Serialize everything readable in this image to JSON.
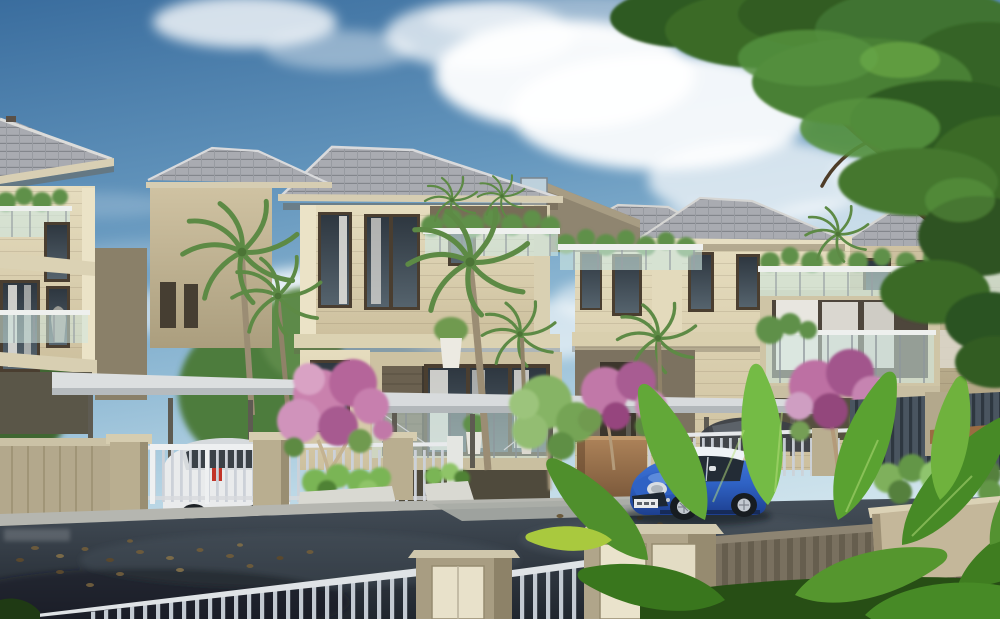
{
  "scene": {
    "type": "architectural-exterior-3d-render",
    "description": "Real-estate 3D rendering: a row of modern beige villas with grey hip tile roofs, glass-railed balconies and roof terraces with plants, palm trees and pink bougainvillea in front yards, silver picket fences with stone pillars, a white car parked behind a gate, a dark sedan behind a fence, a blue MINI-style hatchback with a white roof parked on a dark asphalt street with scattered fallen leaves, a slatted foreground fence with stone pillars, large glossy tropical leaves in the right foreground, and a leafy tree branch overhanging from the top-right under a blue sky with cumulus clouds.",
    "watermark_text": ""
  },
  "objects": [
    "sky",
    "cumulus-clouds",
    "overhanging-tree",
    "villa-left",
    "villa-main",
    "villa-back",
    "villa-right",
    "secondary-roof",
    "glass-balustrade-terrace",
    "balcony-box",
    "carport-canopy",
    "palm-trees",
    "bougainvillea-trees",
    "green-garden-tree",
    "white-car",
    "grey-sedan",
    "tan-gate-wall",
    "silver-picket-fence",
    "stone-fence-pillars",
    "planter-boxes",
    "sidewalk",
    "asphalt-street",
    "driveway-pad",
    "fallen-leaves",
    "blue-mini-hatchback",
    "foreground-fence",
    "slat-wall",
    "tropical-foreground-leaves",
    "watermark-smudge"
  ],
  "palette": {
    "sky_top": "#3a6d9e",
    "sky_mid": "#8fb9d4",
    "sky_horizon": "#d4e6ee",
    "cloud_white": "#ffffff",
    "roof_tile": "#a9abb1",
    "roof_ridge": "#dcdcda",
    "wall_light": "#e0d7b8",
    "wall_dark": "#c2b595",
    "wall_wing_taupe": "#8f8570",
    "window_frame_brown": "#4a3e30",
    "glass_dark": "#333d46",
    "curtain_white": "#e8e6e0",
    "balustrade_aqua": "#cfe7e0",
    "foliage_dark": "#2f5a20",
    "foliage_light": "#55913d",
    "palm_green": "#5d8a45",
    "bougainvillea_pink": "#c178a8",
    "fence_silver": "#c7cdd4",
    "pillar_beige": "#b0a58a",
    "panel_cream": "#e8e1ca",
    "slat_brown": "#79705f",
    "asphalt_top": "#454f59",
    "asphalt_bottom": "#20262e",
    "sidewalk_grey": "#b5b6b0",
    "car_white": "#e9ebec",
    "mini_blue": "#2f62c4",
    "mini_blue_deep": "#1d3f8f",
    "mini_roof_white": "#eff3f6",
    "leaf_green_bright": "#74bb45",
    "leaf_green_dark": "#3f7d20",
    "trunk_brown": "#9b8d74"
  }
}
